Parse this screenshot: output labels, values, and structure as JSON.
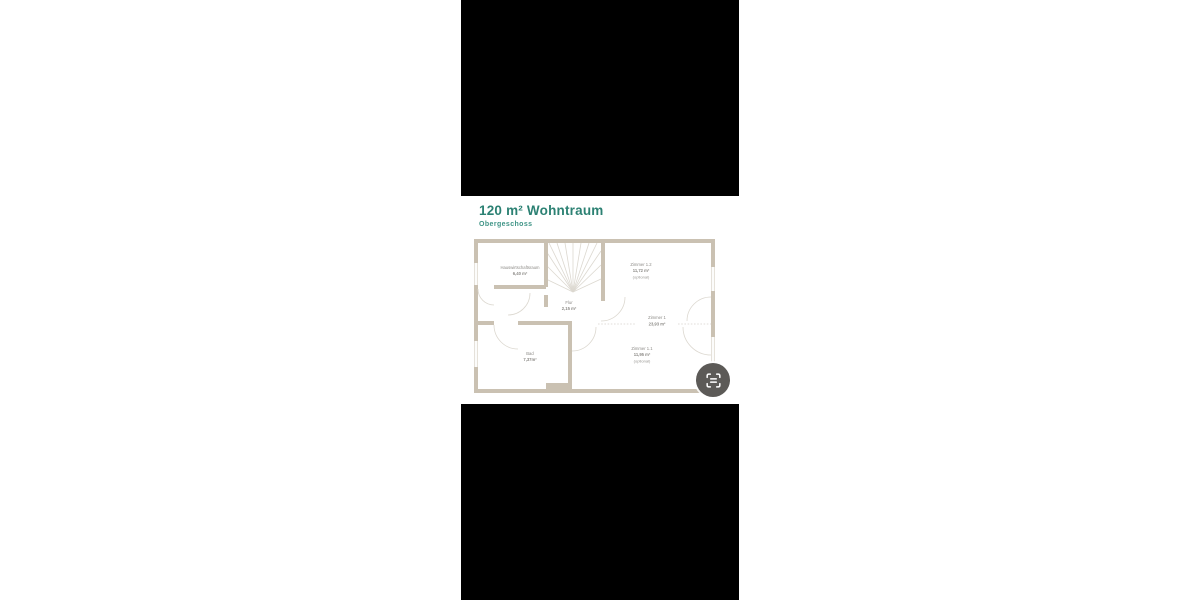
{
  "theme": {
    "page_bg": "#ffffff",
    "panel_color": "#000000",
    "title_color": "#2c8173",
    "subtitle_color": "#3f9486",
    "wall_color": "#cac1b2",
    "door_line_color": "#dcd8d0",
    "label_color": "#8d8b87",
    "icon_bg": "#5c5a57",
    "icon_fg": "#ffffff"
  },
  "header": {
    "title": "120 m² Wohntraum",
    "subtitle": "Obergeschoss"
  },
  "floorplan": {
    "rooms": {
      "hwr": {
        "name": "Hauswirtschaftsraum",
        "area": "6,40 m²",
        "note": ""
      },
      "zimmer12": {
        "name": "Zimmer 1.2",
        "area": "11,72 m²",
        "note": "(optional)"
      },
      "flur": {
        "name": "Flur",
        "area": "2,15 m²",
        "note": ""
      },
      "zimmer1": {
        "name": "Zimmer 1",
        "area": "23,93 m²",
        "note": ""
      },
      "bad": {
        "name": "Bad",
        "area": "7,37m²",
        "note": ""
      },
      "zimmer11": {
        "name": "Zimmer 1.1",
        "area": "11,95 m²",
        "note": "(optional)"
      }
    }
  }
}
